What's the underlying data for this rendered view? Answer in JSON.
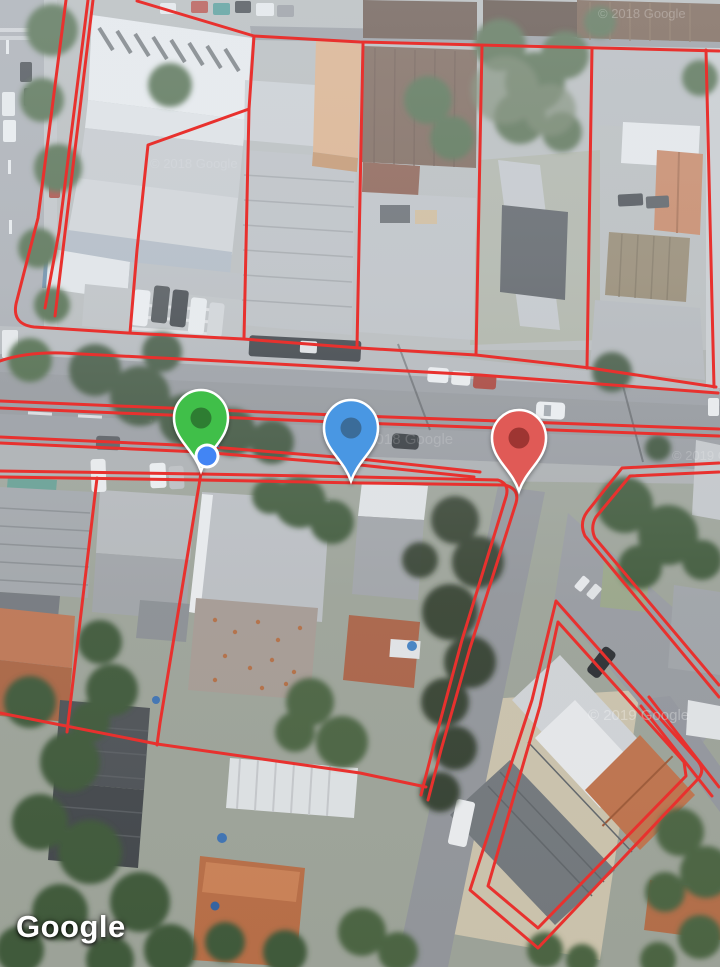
{
  "map": {
    "view_type": "satellite",
    "attribution": {
      "logo_text": "Google",
      "logo_color": "#ffffff"
    },
    "watermarks": [
      {
        "text": "© 2018 Google"
      },
      {
        "text": "© 2018 Google"
      },
      {
        "text": "© 2019 Google"
      },
      {
        "text": "© 2019 Google"
      },
      {
        "text": "© 2018 Google"
      }
    ],
    "overlay": {
      "parcel_line_color": "#e8312e"
    },
    "markers": [
      {
        "id": "green",
        "color": "#3fbf4a",
        "inner_dot_color": "#2e7d33",
        "outline_color": "#ffffff"
      },
      {
        "id": "blue",
        "color": "#4a97e3",
        "inner_dot_color": "#3a6c99",
        "outline_color": "#ffffff"
      },
      {
        "id": "red",
        "color": "#e05a56",
        "inner_dot_color": "#9e3533",
        "outline_color": "#ffffff"
      }
    ],
    "user_location": {
      "dot_color": "#4285f4",
      "ring_color": "#ffffff",
      "heading_color": "#4285f4"
    }
  }
}
